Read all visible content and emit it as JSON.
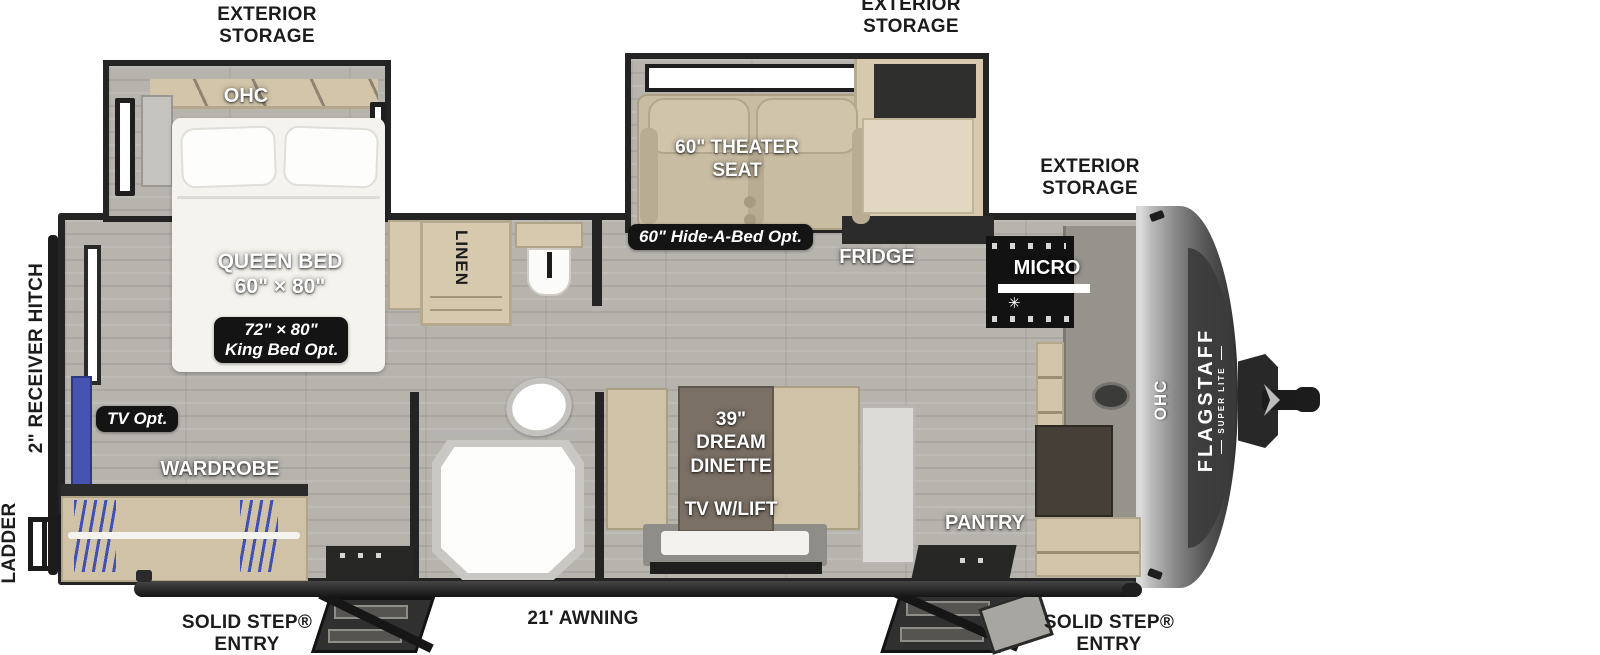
{
  "colors": {
    "accent_blue": "#4653b0",
    "badge_bg": "#141414",
    "wall": "#242424",
    "floor": "#b7b4ae",
    "wood": "#d6c9ae",
    "seat_tan": "#c8bca2",
    "cap_silver": "#8a8a8a"
  },
  "exterior": {
    "storage_line1": "EXTERIOR",
    "storage_line2": "STORAGE",
    "receiver_hitch": "2\" RECEIVER HITCH",
    "ladder": "LADDER",
    "solid_step_line1": "SOLID STEP®",
    "solid_step_line2": "ENTRY",
    "awning": "21' AWNING"
  },
  "bedroom": {
    "ohc": "OHC",
    "queen_line1": "QUEEN BED",
    "queen_line2": "60\" × 80\"",
    "king_opt_line1": "72\" × 80\"",
    "king_opt_line2": "King Bed Opt.",
    "tv_opt": "TV Opt.",
    "wardrobe": "WARDROBE"
  },
  "bath": {
    "linen": "LINEN"
  },
  "living": {
    "theater_line1": "60\" THEATER",
    "theater_line2": "SEAT",
    "hide_a_bed": "60\" Hide-A-Bed Opt.",
    "fridge": "FRIDGE",
    "dinette_line1": "39\"",
    "dinette_line2": "DREAM",
    "dinette_line3": "DINETTE",
    "tv_lift": "TV W/LIFT"
  },
  "kitchen": {
    "micro": "MICRO",
    "ohc": "OHC",
    "pantry": "PANTRY",
    "snowflake_icon": "✳"
  },
  "front": {
    "brand": "FLAGSTAFF",
    "brand_sub": "SUPER LITE"
  }
}
